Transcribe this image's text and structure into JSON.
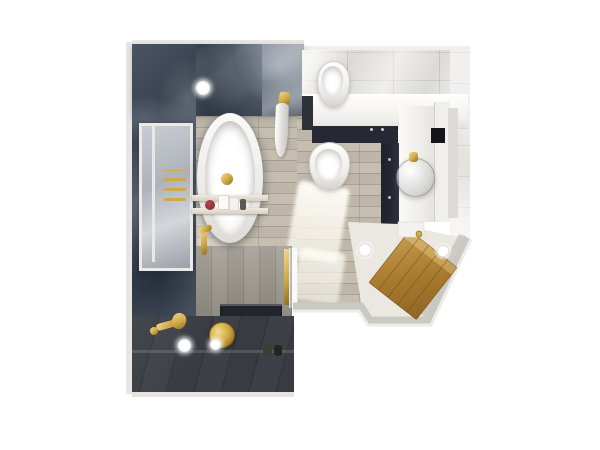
{
  "scene": {
    "type": "photorealistic 3D top-down floor plan render",
    "room": "bathroom",
    "background": "white",
    "visible_text": "none"
  },
  "palette": {
    "marble_dark": "#4a5463",
    "slate": "#34383e",
    "plank_wall": "#96928a",
    "wood_floor": "#beb7a9",
    "marble_light": "#dcdad5",
    "counter_white": "#f4f2ef",
    "navy": "#262933",
    "gold": "#cfa845",
    "gold_light": "#f0d98c",
    "gold_dark": "#8f6e1d",
    "door_wood": "#aa7c2e",
    "sunlight": "#fffdf3"
  },
  "fixtures": [
    {
      "name": "bathtub",
      "label": "Freestanding oval bathtub"
    },
    {
      "name": "bath-caddy",
      "label": "Bath caddy tray with rose, candles and bottle"
    },
    {
      "name": "tub-filler",
      "label": "Gold freestanding tub filler"
    },
    {
      "name": "toilet",
      "label": "Wall-hung toilet"
    },
    {
      "name": "bidet",
      "label": "Wall-hung bidet"
    },
    {
      "name": "cistern-counter",
      "label": "White counter over concealed cistern"
    },
    {
      "name": "vanity-cabinet",
      "label": "Dark navy vanity cabinet"
    },
    {
      "name": "vessel-sink",
      "label": "Glass vessel sink with gold faucet"
    },
    {
      "name": "mirror",
      "label": "Mirror panel"
    },
    {
      "name": "entry-door",
      "label": "Wooden entry door on angled wall"
    },
    {
      "name": "shower",
      "label": "Walk-in shower with dark slate tiles"
    },
    {
      "name": "rain-shower-head",
      "label": "Gold rain shower head"
    },
    {
      "name": "hand-shower",
      "label": "Gold hand shower and mixer"
    },
    {
      "name": "shower-niche",
      "label": "Shower storage niche"
    },
    {
      "name": "shower-screen",
      "label": "Glass shower screen with gold frame"
    },
    {
      "name": "window",
      "label": "Window in marble wall"
    },
    {
      "name": "towel-warmer",
      "label": "Gold towel warmer"
    },
    {
      "name": "hanging-towel",
      "label": "Towel on gold hook"
    },
    {
      "name": "downlights",
      "label": "Ceiling downlights",
      "count": 5
    },
    {
      "name": "waste-bin",
      "label": "Small waste bin"
    },
    {
      "name": "toiletry-bottles",
      "label": "Toiletry bottles on shower floor"
    }
  ]
}
